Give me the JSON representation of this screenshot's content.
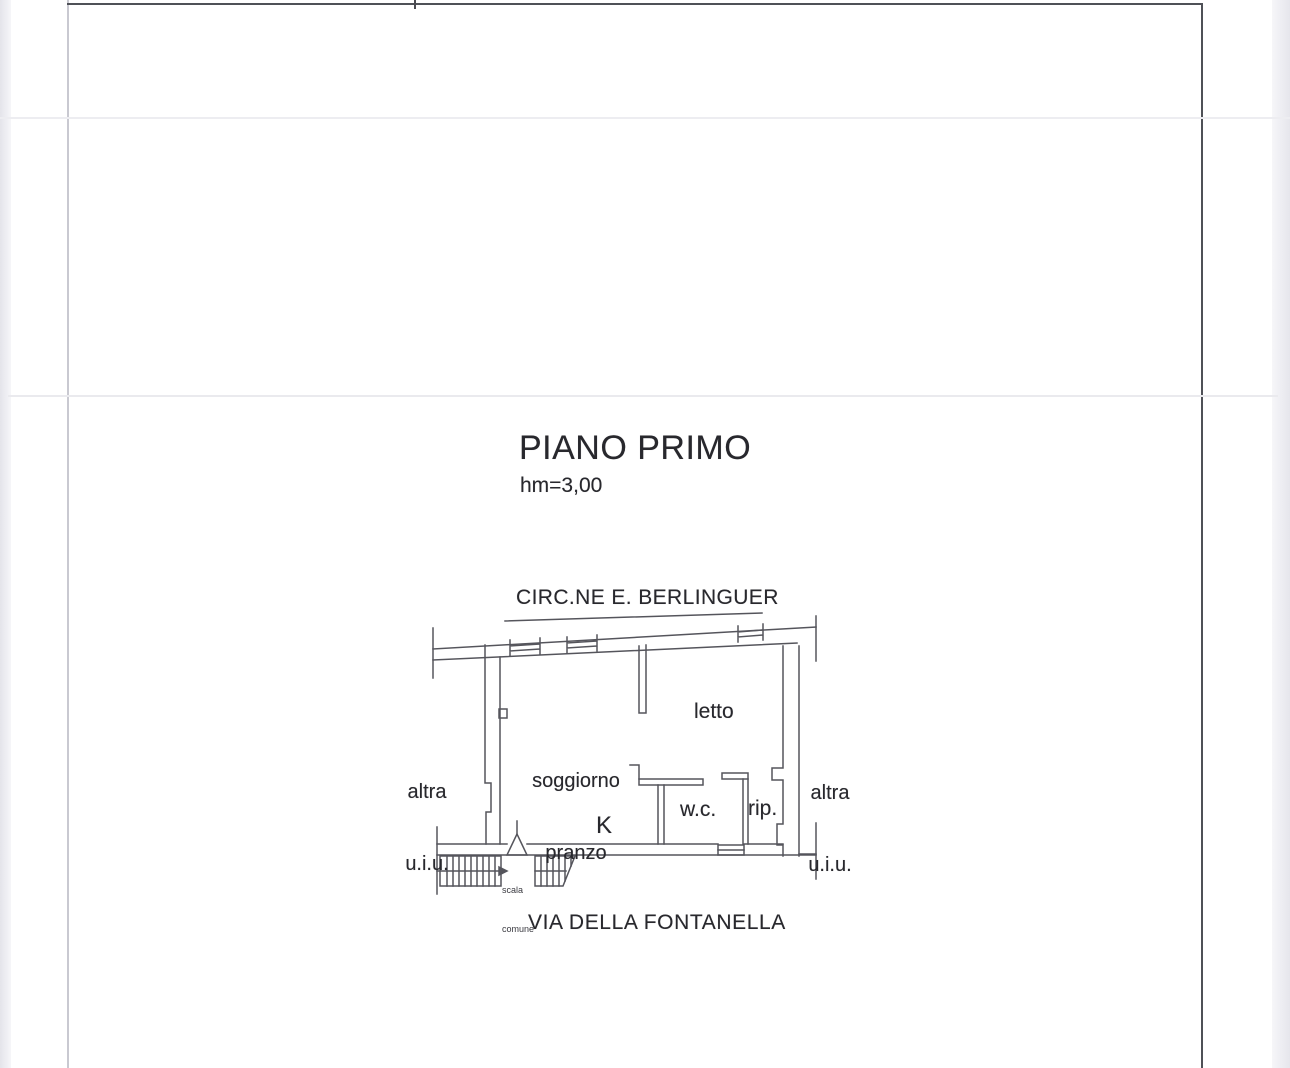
{
  "colors": {
    "page_background": "#ffffff",
    "scan_edge": "#e6e6ec",
    "frame_dark": "#4f5157",
    "frame_light": "#c9c9d1",
    "plan_line": "#55555c",
    "text": "#28282d"
  },
  "titles": {
    "floor": "PIANO PRIMO",
    "height_note": "hm=3,00"
  },
  "streets": {
    "top": "CIRC.NE E. BERLINGUER",
    "bottom": "VIA DELLA FONTANELLA"
  },
  "plan": {
    "rooms": {
      "living": {
        "line1": "soggiorno",
        "line2": "pranzo"
      },
      "bedroom": "letto",
      "wc": "w.c.",
      "storage": "rip.",
      "kitchen": "K"
    },
    "adjacent_units": {
      "left": {
        "line1": "altra",
        "line2": "u.i.u."
      },
      "right": {
        "line1": "altra",
        "line2": "u.i.u."
      }
    },
    "stairs": {
      "line1": "scala",
      "line2": "comune"
    }
  }
}
